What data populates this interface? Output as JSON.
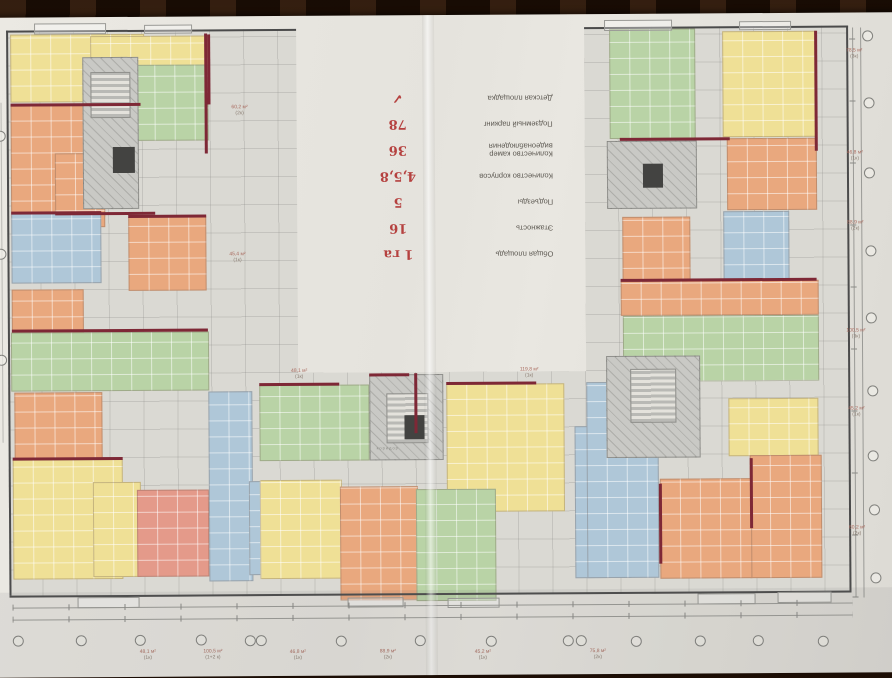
{
  "photo": {
    "subject": "residential complex floor plan drawing, photographed upside down on a dark wood table"
  },
  "info_table": {
    "rows": [
      {
        "label": "Общая площадь",
        "value": "1 га"
      },
      {
        "label": "Этажность",
        "value": "16"
      },
      {
        "label": "Подъезды",
        "value": "5"
      },
      {
        "label": "Количество корпусов",
        "value": "4,5,8"
      },
      {
        "label": "Количество камер видеонаблюдения",
        "value": "36"
      },
      {
        "label": "Подземный паркинг",
        "value": "78"
      },
      {
        "label": "Детская площадка",
        "value": "✓"
      }
    ],
    "value_color": "#b5413f"
  },
  "palette": {
    "apartment_orange": "#e9a87e",
    "apartment_yellow": "#efe096",
    "apartment_green": "#b9d3a6",
    "apartment_blue": "#afc7d8",
    "apartment_pink": "#e49a8a",
    "core_gray": "#c9c9c5",
    "wall_red": "#7e2836",
    "paper": "#e7e5df",
    "wood": "#33190c"
  },
  "annotations": {
    "core_label": "коридор",
    "center_top_labels": [
      {
        "l1": "48,1 м²",
        "l2": "(1к)"
      },
      {
        "l1": "119,8 м²",
        "l2": "(1к)"
      }
    ],
    "side_labels": [
      {
        "l1": "60,2 м²",
        "l2": "(2к)"
      },
      {
        "l1": "45,4 м²",
        "l2": "(1к)"
      }
    ],
    "right_labels": [
      {
        "l1": "78,5 м²",
        "l2": "(3к)"
      },
      {
        "l1": "46,8 м²",
        "l2": "(1к)"
      },
      {
        "l1": "88,9 м²",
        "l2": "(2к)"
      },
      {
        "l1": "100,5 м²",
        "l2": "(3к)"
      },
      {
        "l1": "45,2 м²",
        "l2": "(1к)"
      },
      {
        "l1": "60,2 м²",
        "l2": "(2к)"
      }
    ],
    "bottom_labels": [
      {
        "l1": "48,1 м²",
        "l2": "(1к)"
      },
      {
        "l1": "100,5 м²",
        "l2": "(1+2 к)"
      },
      {
        "l1": "46,8 м²",
        "l2": "(1к)"
      },
      {
        "l1": "88,9 м²",
        "l2": "(2к)"
      },
      {
        "l1": "45,2 м²",
        "l2": "(1к)"
      },
      {
        "l1": "75,8 м²",
        "l2": "(2к)"
      }
    ]
  }
}
